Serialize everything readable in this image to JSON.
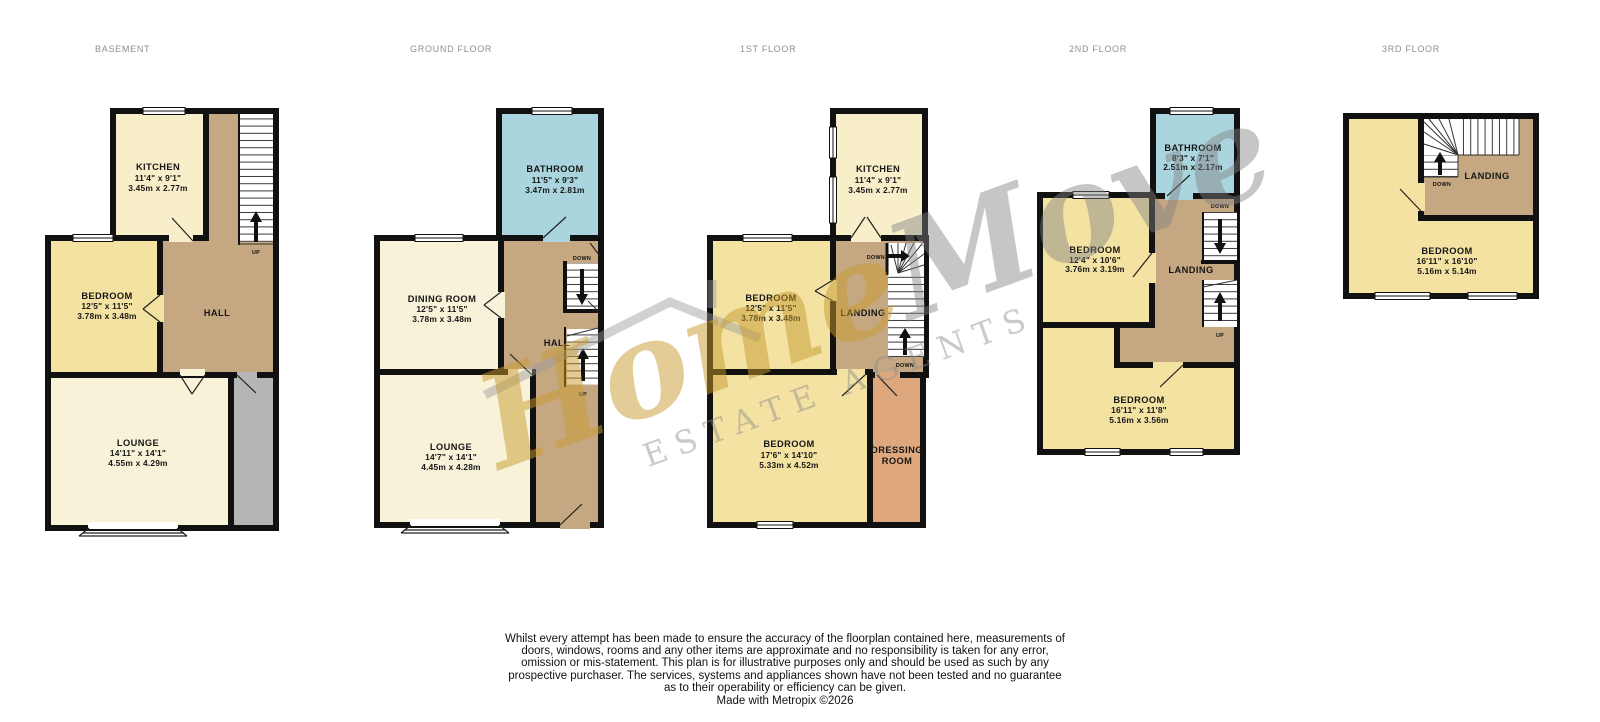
{
  "floors": {
    "basement": {
      "title": "BASEMENT",
      "rooms": {
        "kitchen": {
          "name": "KITCHEN",
          "imperial": "11'4\" x 9'1\"",
          "metric": "3.45m x 2.77m"
        },
        "bedroom": {
          "name": "BEDROOM",
          "imperial": "12'5\" x 11'5\"",
          "metric": "3.78m x 3.48m"
        },
        "hall": {
          "name": "HALL"
        },
        "lounge": {
          "name": "LOUNGE",
          "imperial": "14'11\" x 14'1\"",
          "metric": "4.55m x 4.29m"
        }
      },
      "stairs": {
        "up": "UP"
      }
    },
    "ground": {
      "title": "GROUND FLOOR",
      "rooms": {
        "bathroom": {
          "name": "BATHROOM",
          "imperial": "11'5\" x 9'3\"",
          "metric": "3.47m x 2.81m"
        },
        "dining": {
          "name": "DINING ROOM",
          "imperial": "12'5\" x 11'5\"",
          "metric": "3.78m x 3.48m"
        },
        "hall": {
          "name": "HALL"
        },
        "lounge": {
          "name": "LOUNGE",
          "imperial": "14'7\" x 14'1\"",
          "metric": "4.45m x 4.28m"
        }
      },
      "stairs": {
        "down": "DOWN",
        "up": "UP"
      }
    },
    "first": {
      "title": "1ST FLOOR",
      "rooms": {
        "kitchen": {
          "name": "KITCHEN",
          "imperial": "11'4\" x 9'1\"",
          "metric": "3.45m x 2.77m"
        },
        "bedroom1": {
          "name": "BEDROOM",
          "imperial": "12'5\" x 11'5\"",
          "metric": "3.78m x 3.48m"
        },
        "landing": {
          "name": "LANDING"
        },
        "bedroom2": {
          "name": "BEDROOM",
          "imperial": "17'6\" x 14'10\"",
          "metric": "5.33m x 4.52m"
        },
        "dressing": {
          "line1": "DRESSING",
          "line2": "ROOM"
        }
      },
      "stairs": {
        "down_top": "DOWN",
        "down_bottom": "DOWN"
      }
    },
    "second": {
      "title": "2ND FLOOR",
      "rooms": {
        "bathroom": {
          "name": "BATHROOM",
          "imperial": "8'3\" x 7'1\"",
          "metric": "2.51m x 2.17m"
        },
        "bedroom1": {
          "name": "BEDROOM",
          "imperial": "12'4\" x 10'6\"",
          "metric": "3.76m x 3.19m"
        },
        "landing": {
          "name": "LANDING"
        },
        "bedroom2": {
          "name": "BEDROOM",
          "imperial": "16'11\" x 11'8\"",
          "metric": "5.16m x 3.56m"
        }
      },
      "stairs": {
        "down": "DOWN",
        "up": "UP"
      }
    },
    "third": {
      "title": "3RD FLOOR",
      "rooms": {
        "landing": {
          "name": "LANDING"
        },
        "bedroom": {
          "name": "BEDROOM",
          "imperial": "16'11\" x 16'10\"",
          "metric": "5.16m x 5.14m"
        }
      },
      "stairs": {
        "down": "DOWN"
      }
    }
  },
  "watermark": {
    "brand_gold": "Home",
    "brand_gray": "Move",
    "tagline": "ESTATE AGENTS",
    "gold_color": "#c79a2e",
    "gray_color": "#808080"
  },
  "colors": {
    "wall": "#111111",
    "hall_brown": "#c5a881",
    "bedroom_yellow": "#f3e2a2",
    "kitchen_cream": "#f8eeca",
    "lounge_cream": "#f8f2d9",
    "bathroom_blue": "#aad4de",
    "dressing_salmon": "#dfa87c",
    "void_gray": "#b5b5b5"
  },
  "disclaimer": {
    "text": "Whilst every attempt has been made to ensure the accuracy of the floorplan contained here, measurements of doors, windows, rooms and any other items are approximate and no responsibility is taken for any error, omission or mis-statement. This plan is for illustrative purposes only and should be used as such by any prospective purchaser. The services, systems and appliances shown have not been tested and no guarantee as to their operability or efficiency can be given.",
    "credit": "Made with Metropix ©2026"
  }
}
